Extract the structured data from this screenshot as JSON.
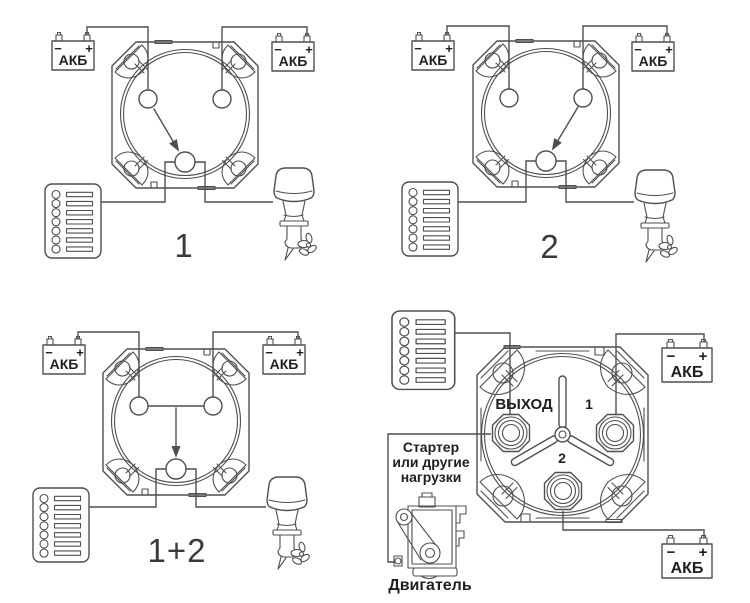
{
  "colors": {
    "background": "#ffffff",
    "line": "#4f4f4f",
    "text": "#1f1f1f",
    "number": "#3a3a3a"
  },
  "labels": {
    "battery": "АКБ",
    "minus": "−",
    "plus": "+"
  },
  "panels": {
    "top_left": {
      "caption": "1",
      "components": [
        "battery-icon",
        "battery-icon",
        "selector-switch-icon",
        "fuse-panel-icon",
        "outboard-motor-icon"
      ]
    },
    "top_right": {
      "caption": "2",
      "components": [
        "battery-icon",
        "battery-icon",
        "selector-switch-icon",
        "fuse-panel-icon",
        "outboard-motor-icon"
      ]
    },
    "bottom_left": {
      "caption": "1+2",
      "components": [
        "battery-icon",
        "battery-icon",
        "selector-switch-icon",
        "fuse-panel-icon",
        "outboard-motor-icon"
      ]
    },
    "bottom_right": {
      "output_label": "ВЫХОД",
      "terminal_1_label": "1",
      "terminal_2_label": "2",
      "starter_label_lines": [
        "Стартер",
        "или другие",
        "нагрузки"
      ],
      "engine_label": "Двигатель",
      "components": [
        "fuse-panel-icon",
        "battery-icon",
        "battery-icon",
        "detailed-selector-switch-icon",
        "engine-icon"
      ]
    }
  }
}
